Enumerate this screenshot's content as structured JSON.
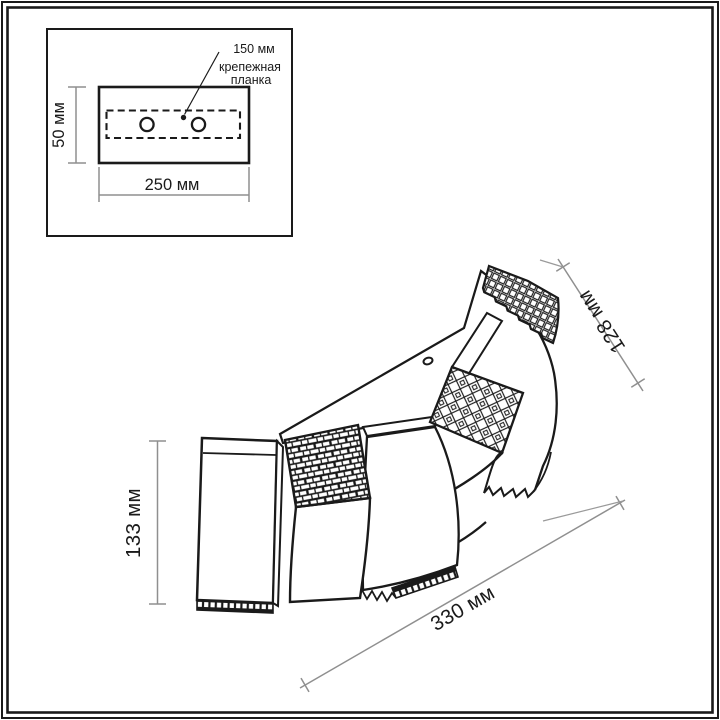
{
  "inset": {
    "spacing_label": "150 мм",
    "part_label_line1": "крепежная",
    "part_label_line2": "планка",
    "height_label": "50 мм",
    "width_label": "250 мм"
  },
  "dimensions": {
    "height_label": "133 мм",
    "depth_label": "128 мм",
    "width_label": "330 мм"
  },
  "colors": {
    "ink": "#1a1a1a",
    "dimension_line": "#8f8f8f",
    "background": "#ffffff"
  }
}
